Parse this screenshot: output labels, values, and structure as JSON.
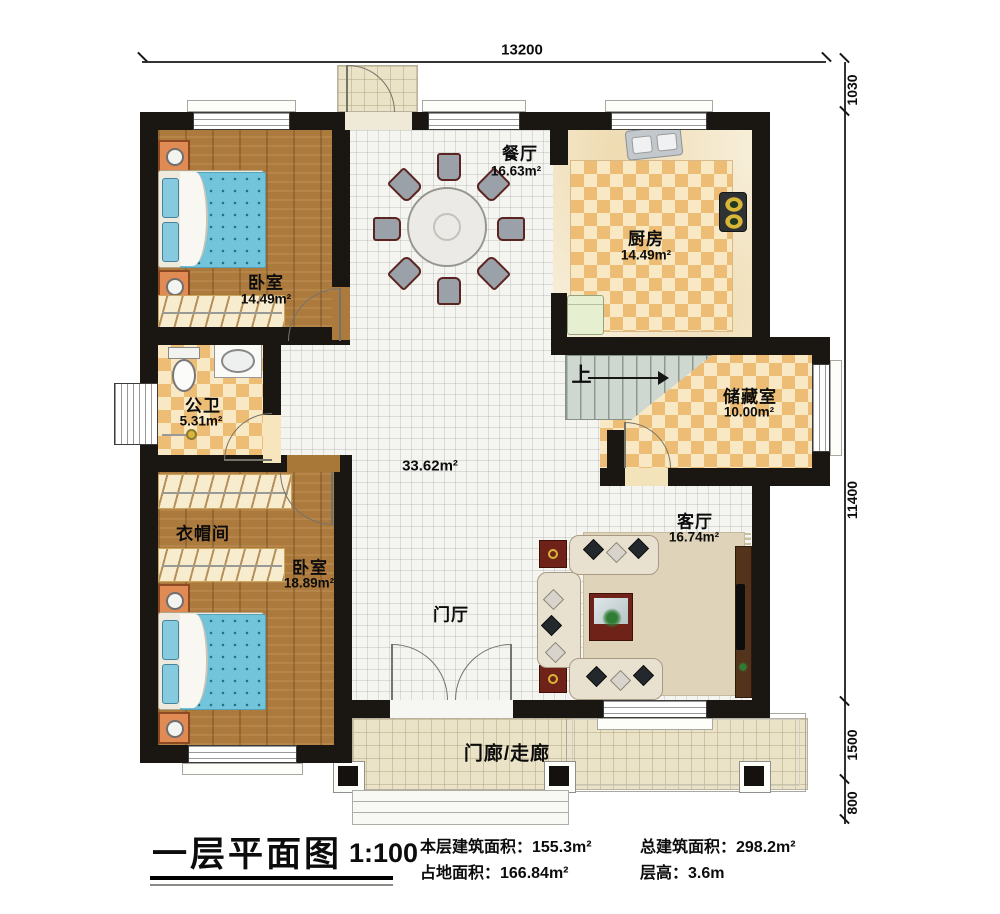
{
  "title_block": {
    "title": "一层平面图",
    "scale": "1:100",
    "info": [
      "本层建筑面积：155.3m²",
      "占地面积：166.84m²",
      "总建筑面积：298.2m²",
      "层高：3.6m"
    ]
  },
  "dimensions": {
    "top": "13200",
    "right": [
      "1030",
      "11400",
      "1500",
      "800"
    ]
  },
  "rooms": {
    "dining": {
      "name": "餐厅",
      "area": "16.63m²"
    },
    "kitchen": {
      "name": "厨房",
      "area": "14.49m²"
    },
    "bedroom1": {
      "name": "卧室",
      "area": "14.49m²"
    },
    "bathroom": {
      "name": "公卫",
      "area": "5.31m²"
    },
    "cloakroom": {
      "name": "衣帽间"
    },
    "bedroom2": {
      "name": "卧室",
      "area": "18.89m²"
    },
    "storage": {
      "name": "储藏室",
      "area": "10.00m²"
    },
    "living": {
      "name": "客厅",
      "area": "16.74m²"
    },
    "hall": {
      "area": "33.62m²"
    },
    "foyer": {
      "name": "门厅"
    },
    "porch": {
      "name": "门廊/走廊"
    },
    "stairs": {
      "up_label": "上"
    }
  },
  "colors": {
    "wall": "#1a1713",
    "wood_floor": "#ad7a3e",
    "checker_dark": "#eebd75",
    "checker_light": "#f8e9c4",
    "white_tile": "#f4f4f1",
    "porch_tile": "#ebe3c8",
    "bed_blue": "#72c4da",
    "stair_green": "#cfd8d0",
    "accent_red": "#6e2218",
    "marble": "#f7eed8"
  }
}
